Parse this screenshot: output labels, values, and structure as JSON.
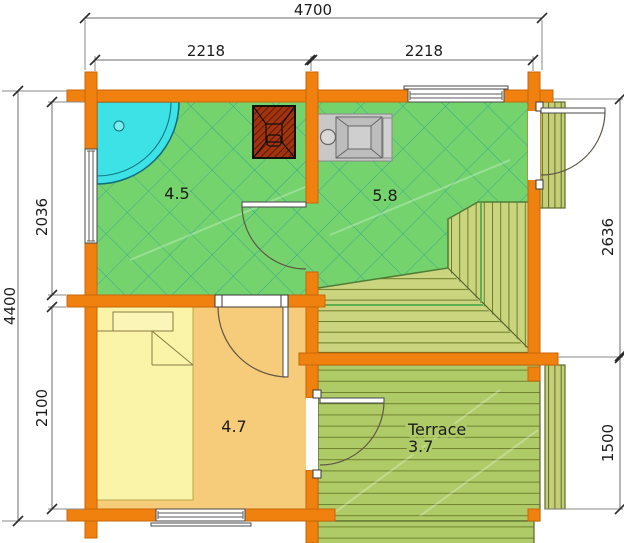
{
  "plan": {
    "dims": {
      "top_total": "4700",
      "top_left": "2218",
      "top_right": "2218",
      "left_total": "4400",
      "left_upper": "2036",
      "left_lower": "2100",
      "right_upper": "2636",
      "right_lower": "1500"
    },
    "rooms": {
      "shower_room_area": "4.5",
      "main_room_area": "5.8",
      "bedroom_area": "4.7",
      "terrace_name": "Terrace",
      "terrace_area": "3.7"
    },
    "colors": {
      "wall_orange": "#F0810E",
      "wall_border": "#C8660A",
      "room_green": "#74D36D",
      "crosshatch_line": "#38A88E",
      "bedroom_tan": "#F6CB79",
      "bed_yellow": "#F9F4A8",
      "terrace_green": "#AECB67",
      "deck_green": "#CBD57F",
      "plank_line": "#6D7C2C",
      "shower_cyan": "#3CE2E6",
      "stove_red": "#A1330F",
      "sink_gray": "#C8C8C8"
    }
  }
}
